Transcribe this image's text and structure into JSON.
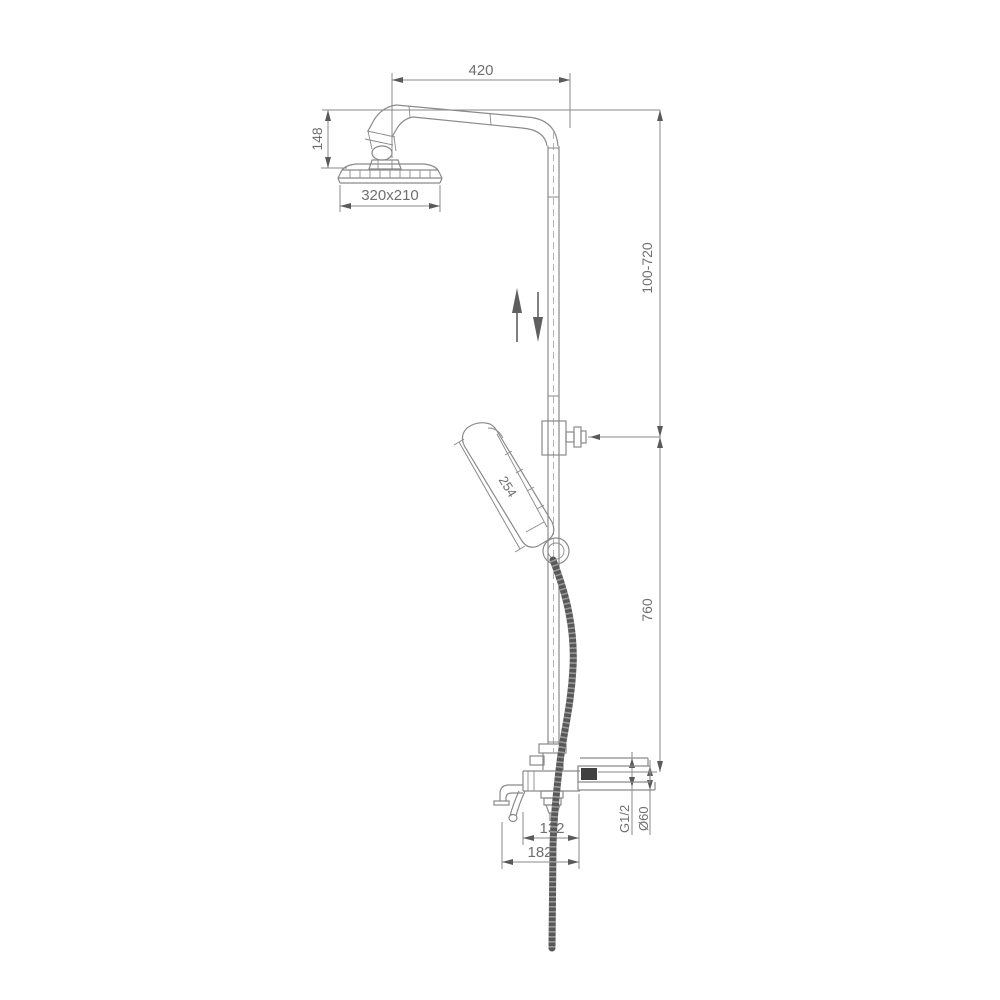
{
  "drawing": {
    "type": "technical-dimension-drawing",
    "subject": "shower column with overhead shower, adjustable hand shower and bath spout",
    "dimensions": {
      "arm_projection": "420",
      "head_height": "148",
      "head_size": "320x210",
      "adjustable_range": "100-720",
      "riser_height": "760",
      "handset_length": "254",
      "thread_size": "G1/2",
      "escutcheon_diameter": "Ø60",
      "spout_to_handle": "132",
      "spout_projection": "182"
    },
    "colors": {
      "line": "#8a8a8a",
      "text": "#6f6f6f",
      "hose": "#585858",
      "dark_fill": "#3f3f3f",
      "arrow": "#5a5a5a",
      "background": "#ffffff"
    }
  }
}
